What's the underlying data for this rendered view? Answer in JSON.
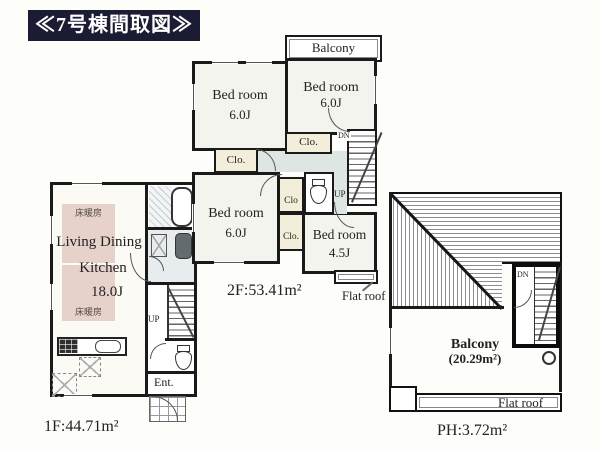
{
  "title": "≪7号棟間取図≫",
  "f1": {
    "area_label": "1F:44.71m²",
    "room_line1": "Living Dining",
    "room_line2": "Kitchen",
    "room_size": "18.0J",
    "floor_heating_top": "床暖房",
    "floor_heating_bottom": "床暖房",
    "entrance_label": "Ent.",
    "up_label": "UP"
  },
  "f2": {
    "area_label": "2F:53.41m²",
    "balcony_label": "Balcony",
    "rooms": [
      {
        "name": "Bed room",
        "size": "6.0J",
        "position": "top-left"
      },
      {
        "name": "Bed room",
        "size": "6.0J",
        "position": "top-right"
      },
      {
        "name": "Bed room",
        "size": "6.0J",
        "position": "bottom-left"
      },
      {
        "name": "Bed room",
        "size": "4.5J",
        "position": "bottom-right"
      }
    ],
    "closets": [
      {
        "label": "Clo."
      },
      {
        "label": "Clo."
      },
      {
        "label": "Clo"
      },
      {
        "label": "Clo."
      }
    ],
    "dn_label": "DN",
    "up_label": "UP",
    "flat_roof_label": "Flat roof"
  },
  "ph": {
    "area_label": "PH:3.72m²",
    "balcony_line1": "Balcony",
    "balcony_line2": "(20.29m²)",
    "dn_label": "DN",
    "flat_roof_label": "Flat roof"
  },
  "colors": {
    "title_bg": "#1b1b33",
    "title_fg": "#ffffff",
    "wall": "#1a1a1a",
    "floor_heating_fill": "#e6d2ca",
    "closet_fill": "#f2eeda",
    "hallway_fill": "#dde6e3",
    "washroom_fill": "#e7edef",
    "paper": "#fdfdfa"
  }
}
